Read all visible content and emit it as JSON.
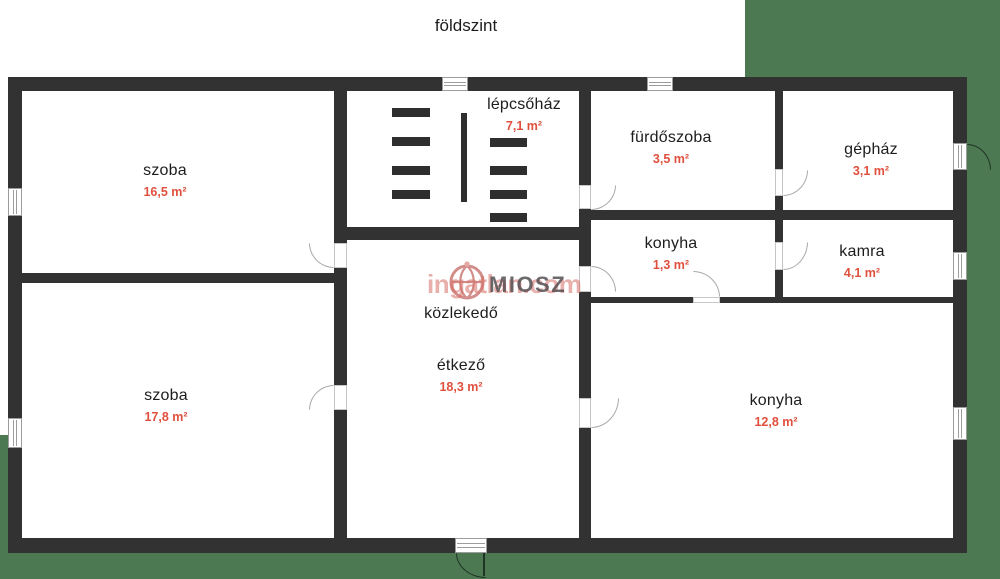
{
  "title": "földszint",
  "watermark": {
    "brand": "ingatlan.com",
    "org": "MIOSZ"
  },
  "colors": {
    "wall": "#333233",
    "background_green": "#4c7852",
    "room_fill": "#ffffff",
    "room_name_text": "#1d1d1d",
    "area_text": "#e0503e",
    "watermark_pink": "#d66e66"
  },
  "rooms": [
    {
      "name": "szoba",
      "area": "16,5 m²"
    },
    {
      "name": "szoba",
      "area": "17,8 m²"
    },
    {
      "name": "lépcsőház",
      "area": "7,1 m²"
    },
    {
      "name": "közlekedő",
      "area": ""
    },
    {
      "name": "étkező",
      "area": "18,3 m²"
    },
    {
      "name": "fürdőszoba",
      "area": "3,5 m²"
    },
    {
      "name": "gépház",
      "area": "3,1 m²"
    },
    {
      "name": "konyha",
      "area": "1,3 m²"
    },
    {
      "name": "kamra",
      "area": "4,1 m²"
    },
    {
      "name": "konyha",
      "area": "12,8 m²"
    }
  ]
}
